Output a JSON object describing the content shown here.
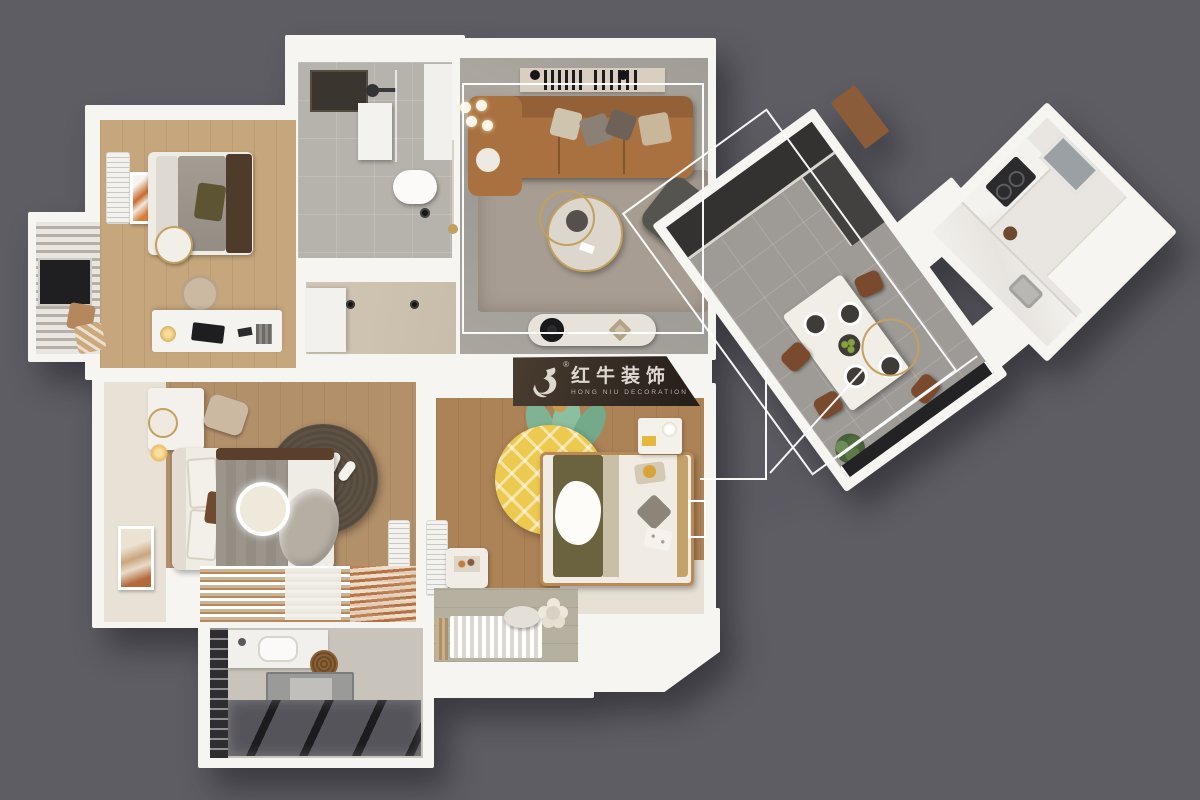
{
  "watermark": {
    "brand_cn": "红牛装饰",
    "brand_en": "HONG NIU DECORATION",
    "registered": "®"
  },
  "palette": {
    "background": "#5e5d64",
    "wall_white": "#f6f5f2",
    "wood_floor": "#b28a5e",
    "light_wood_floor": "#c6a67c",
    "tile_gray": "#b6b2ac",
    "tile_beige": "#cfc4b2",
    "marble_gray": "#a6a29d",
    "rug_taupe": "#a79d92",
    "rug_dark_brown": "#5e5245",
    "sofa_brown": "#a9713f",
    "accent_gold": "#c2a05f",
    "olive_green": "#6b6340",
    "pineapple_yellow": "#ecc94f",
    "leaf_green": "#7fb394",
    "chair_sienna": "#7a4a2e",
    "glass_dark": "#2a2a2e",
    "logo_board": "#342b24"
  }
}
